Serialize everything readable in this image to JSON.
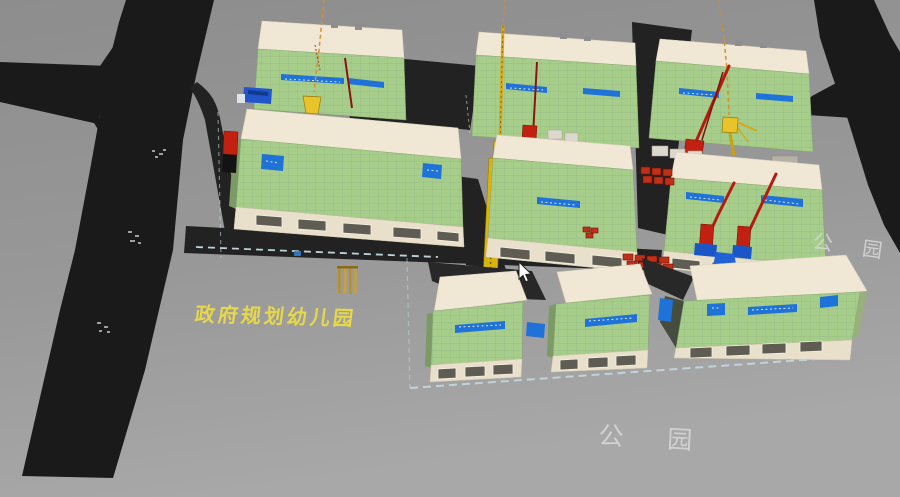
{
  "viewport": {
    "description": "3D construction site BIM model view",
    "labels": {
      "kindergarten": "政府规划幼儿园",
      "park_right": "公园",
      "park_bottom": "公园"
    },
    "objects": {
      "building_count": 9,
      "tower_cranes": 3,
      "placing_booms": 4,
      "construction_hoist": 1,
      "trucks": [
        "mixer-truck-blue",
        "dump-truck-red"
      ]
    },
    "colors": {
      "ground": "#979797",
      "road": "#1a1a1a",
      "facade_green": "#a7cd8b",
      "roof_cream": "#f0e8d5",
      "banner_blue": "#1f72d8",
      "crane_yellow": "#e8c32a",
      "machine_red": "#c22010",
      "label_yellow": "#e6d84a",
      "label_white": "#d6d6d6",
      "boundary_dash": "#c5dbe4"
    }
  }
}
